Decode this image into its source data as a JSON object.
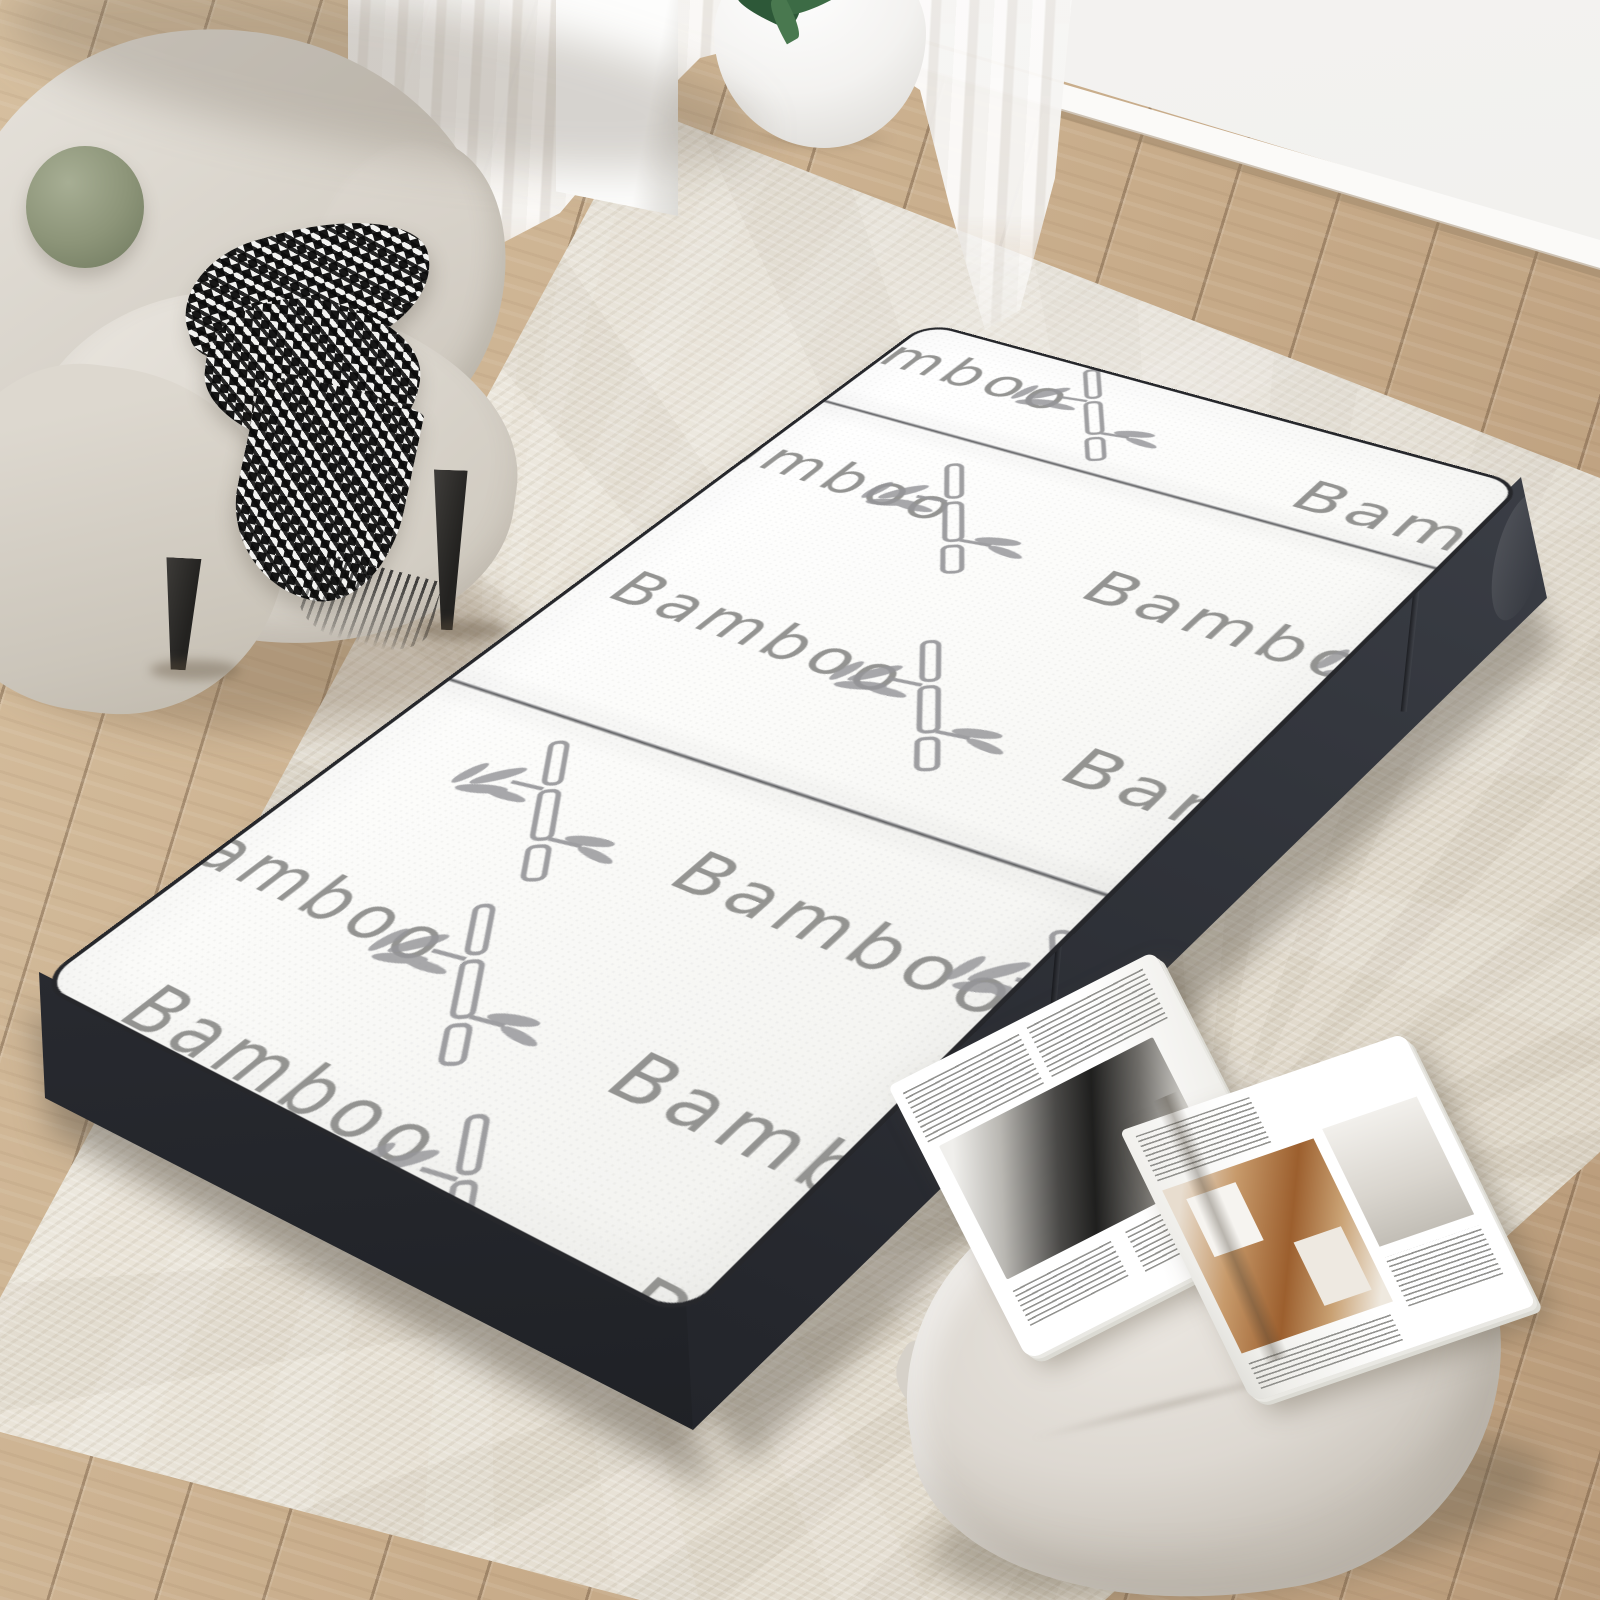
{
  "scene": {
    "mattress": {
      "fabric_label": "Bamboo",
      "panels": 3,
      "top_color": "#fbfbf9",
      "side_color": "#2e3138",
      "pattern_color": "#9a9a98",
      "motif_icon": "bamboo-plant-icon"
    },
    "room": {
      "wall_color": "#f1efec",
      "floor_color": "#c7ac8b",
      "rug_color": "#e8e2d6",
      "armchair_color": "#d8d3ca",
      "ball_pillow_color": "#8e9677",
      "throw_dark": "#161616",
      "throw_light": "#f3f3f1",
      "vase_color": "#f4f3f1",
      "plant_color": "#2d5838",
      "floor_pillow_color": "#ddd8d1"
    }
  }
}
